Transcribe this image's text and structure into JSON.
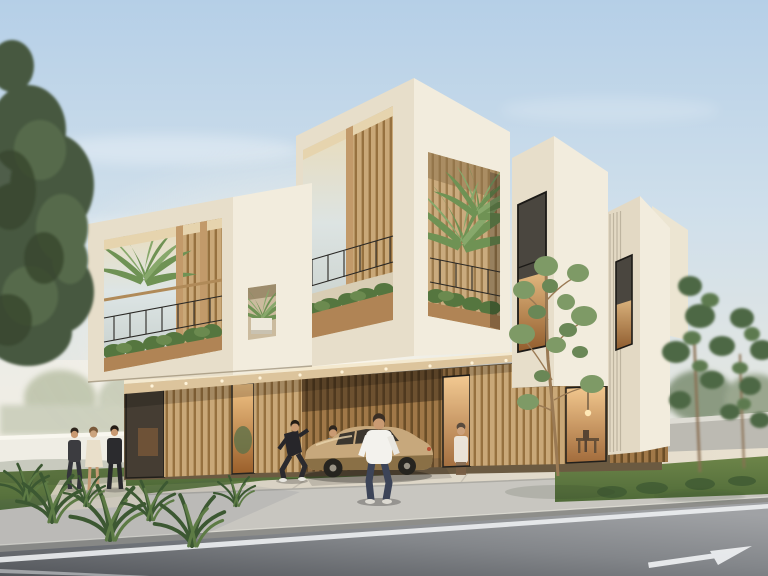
{
  "scene": {
    "description": "Photorealistic architectural rendering of a modern two-storey building made of stacked cream concrete volumes over a timber-slat ground floor, with planted balconies, pedestrians, a parked tan sedan under the cantilever, street trees, a boundary wall, and an asphalt road with a white lane arrow in the foreground."
  },
  "palette": {
    "sky_top": "#b5cfe7",
    "sky_mid": "#cfdfeb",
    "sky_horizon": "#ece9dd",
    "sun_glow": "#fdf7ea",
    "facade_front": "#e7deca",
    "facade_bright": "#f2ecdd",
    "facade_shade": "#ddd2ba",
    "soffit_warm": "#dcc49c",
    "fascia_light": "#f4e9cf",
    "wood_light": "#c9a878",
    "wood_stripe": "#96713f",
    "wood_shade": "#a07848",
    "wood_shade_stripe": "#6b4e28",
    "glass_reflect": "#dde5e5",
    "interior_glow_hi": "#f2c486",
    "interior_glow_lo": "#9a5f2b",
    "hedge_green": "#55763f",
    "palm_green": "#6f9254",
    "palm_green_light": "#87a86b",
    "tree_dark": "#47583f",
    "tree_sage": "#7e9a66",
    "pine_green": "#4d6844",
    "grass": "#6d8549",
    "grass_shade": "#4f6a38",
    "plaza_light": "#e9e1d0",
    "plaza_dark": "#d0cabd",
    "sidewalk": "#c8c6c0",
    "curb": "#8e8e8a",
    "road_light": "#a0a2a5",
    "road_dark": "#53565b",
    "road_line": "#eceef0",
    "wall_left": "#efede4",
    "wall_right": "#bcbab2",
    "car_body": "#c7a87c",
    "car_window": "#3b362e",
    "skin": "#c99a72",
    "shirt_white": "#f3f2ed",
    "pants_navy": "#3c4458",
    "tee_blue": "#5d81a8",
    "outfit_black": "#2b2b2e",
    "dress_beige": "#e9dfca"
  },
  "inventory": {
    "building_blocks": 5,
    "balconies_with_plants": 3,
    "plant_niche": 1,
    "storefront_windows": 3,
    "pedestrians": 7,
    "vehicles": 1,
    "vehicle_type": "tan sedan parked under cantilever",
    "street_trees": 1,
    "pine_trees": 2,
    "large_foreground_tree": 1,
    "road_marking": "white arrow pointing right"
  }
}
